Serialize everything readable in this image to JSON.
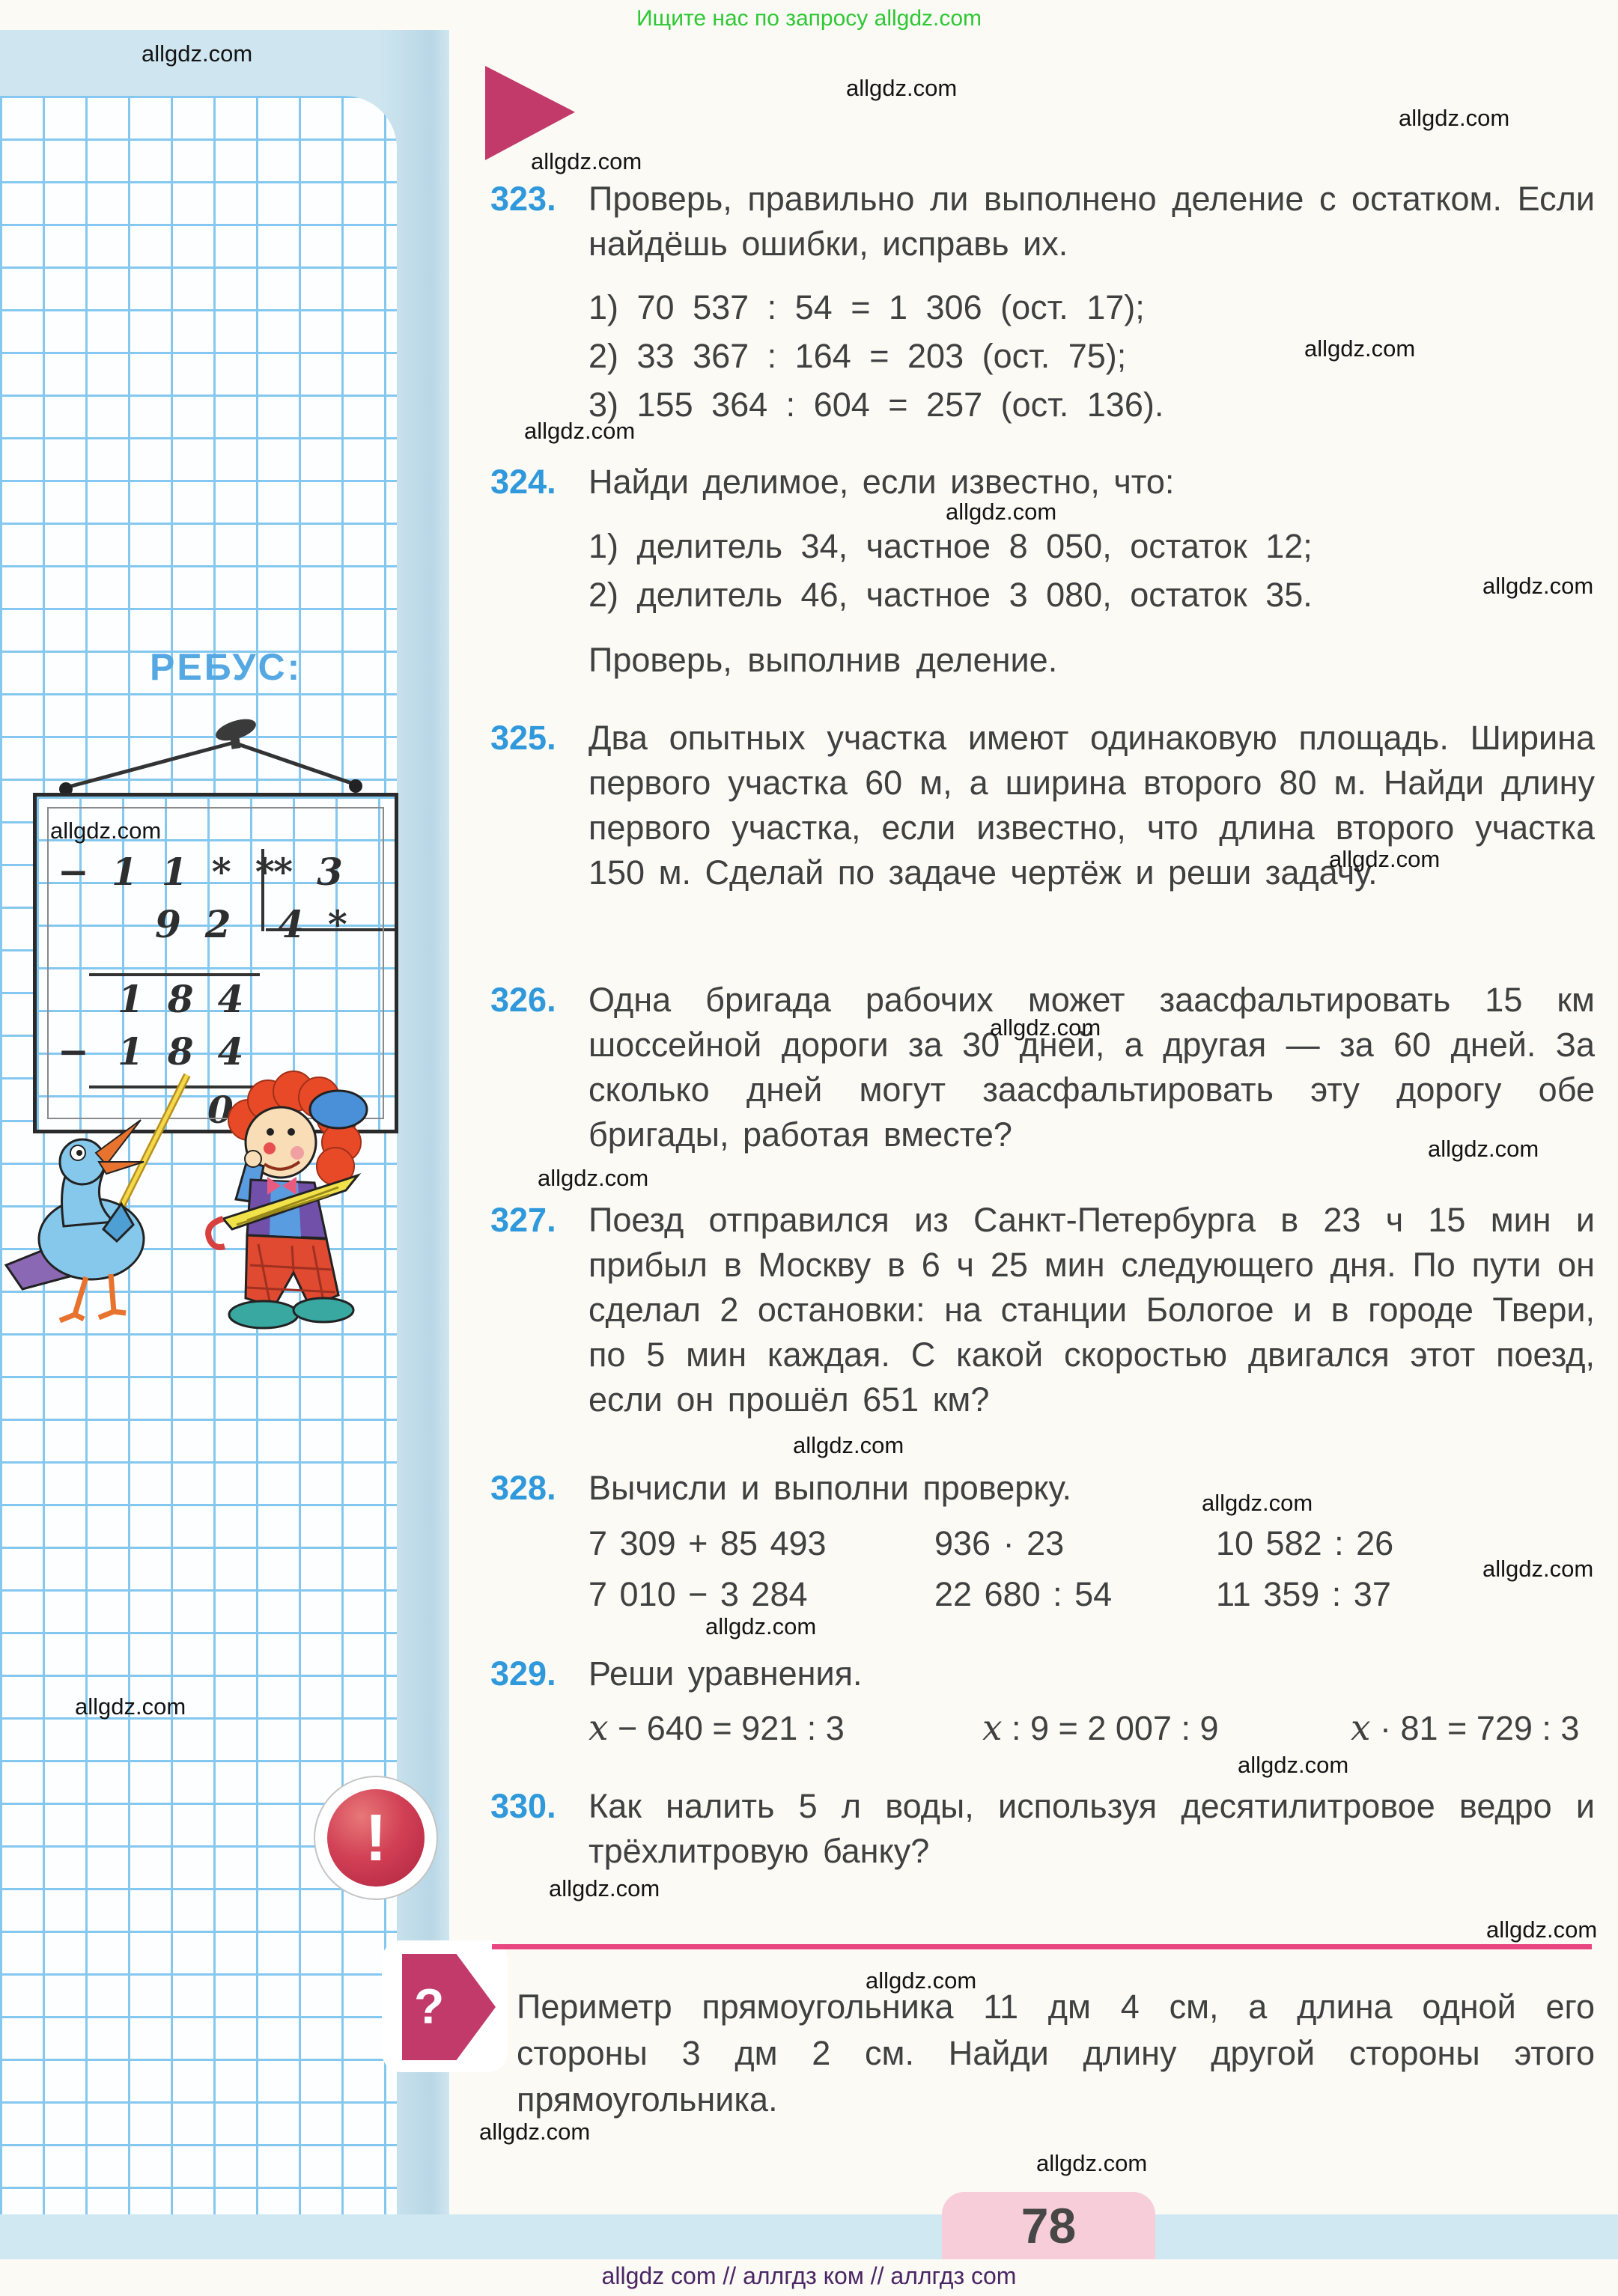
{
  "page": {
    "promo": "Ищите нас по запросу allgdz.com",
    "watermark": "allgdz.com",
    "watermark_positions": [
      [
        189,
        54
      ],
      [
        1130,
        100
      ],
      [
        1868,
        140
      ],
      [
        709,
        198
      ],
      [
        1742,
        448
      ],
      [
        700,
        558
      ],
      [
        1263,
        666
      ],
      [
        1980,
        765
      ],
      [
        67,
        1092
      ],
      [
        1775,
        1130
      ],
      [
        1322,
        1355
      ],
      [
        1907,
        1517
      ],
      [
        718,
        1556
      ],
      [
        1059,
        1913
      ],
      [
        1605,
        1990
      ],
      [
        1980,
        2078
      ],
      [
        942,
        2155
      ],
      [
        100,
        2262
      ],
      [
        1653,
        2340
      ],
      [
        733,
        2505
      ],
      [
        1985,
        2560
      ],
      [
        1156,
        2628
      ],
      [
        640,
        2830
      ],
      [
        1384,
        2872
      ]
    ],
    "page_number": "78",
    "footer": "allgdz com  //  аллгдз ком  //  аллгдз com"
  },
  "sidebar": {
    "rebus_title": "РЕБУС:",
    "rebus": {
      "minus": "−",
      "dividend": "11**",
      "divisor": "*3",
      "quotient": "4*",
      "partial1": "92",
      "product1": "184",
      "product2": "184",
      "remainder": "0"
    }
  },
  "icons": {
    "exclamation": "!",
    "question": "?"
  },
  "problems": [
    {
      "number": "323.",
      "text": "Проверь, правильно ли выполнено деление с остатком. Если найдёшь ошибки, исправь их.",
      "items": [
        "1)  70 537 : 54 = 1 306  (ост. 17);",
        "2)  33 367 : 164 = 203  (ост. 75);",
        "3)  155 364 : 604 = 257  (ост. 136)."
      ]
    },
    {
      "number": "324.",
      "text": "Найди делимое, если известно, что:",
      "items": [
        "1)  делитель 34,  частное 8 050,  остаток 12;",
        "2)  делитель 46,  частное 3 080,  остаток 35."
      ],
      "after": "Проверь, выполнив деление."
    },
    {
      "number": "325.",
      "text": "Два опытных участка имеют одинаковую площадь. Ширина первого участка 60 м, а ширина второго 80 м. Найди длину первого участка, если известно, что длина второго участка 150 м. Сделай по задаче чертёж и реши задачу."
    },
    {
      "number": "326.",
      "text": "Одна бригада рабочих может заасфальтировать 15 км шоссейной дороги за 30 дней, а другая — за 60 дней. За сколько дней могут заасфальтировать эту дорогу обе бригады, работая вместе?"
    },
    {
      "number": "327.",
      "text": "Поезд отправился из Санкт-Петербурга в 23 ч 15 мин и прибыл в Москву в 6 ч 25 мин следующего дня. По пути он сделал 2 остановки: на станции Бологое и в городе Твери, по 5 мин каждая. С какой скоростью двигался этот поезд, если он прошёл 651 км?"
    },
    {
      "number": "328.",
      "text": "Вычисли и выполни проверку.",
      "grid": [
        [
          "7 309 + 85 493",
          "936 · 23",
          "10 582 : 26"
        ],
        [
          "7 010 − 3 284",
          "22 680 : 54",
          "11 359 : 37"
        ]
      ]
    },
    {
      "number": "329.",
      "text": "Реши уравнения.",
      "equations": [
        {
          "v": "x",
          "rest": " − 640 = 921 : 3"
        },
        {
          "v": "x",
          "rest": " : 9 = 2 007 : 9"
        },
        {
          "v": "x",
          "rest": " · 81 = 729 : 3"
        }
      ]
    },
    {
      "number": "330.",
      "text": "Как налить 5 л воды, используя десятилитровое ведро и трёхлитровую банку?"
    }
  ],
  "final_problem": {
    "text": "Периметр прямоугольника 11 дм 4 см, а длина одной его стороны 3 дм 2 см. Найди длину другой стороны этого прямоугольника."
  },
  "colors": {
    "accent_pink": "#c23a6a",
    "rule_pink": "#e8467e",
    "number_blue": "#2f99dc",
    "promo_green": "#2ec834",
    "footer_purple": "#4a2665",
    "tab_pink": "#f7cdd9",
    "grid_blue": "#85c8ef",
    "band_blue": "#cfe6f0"
  }
}
